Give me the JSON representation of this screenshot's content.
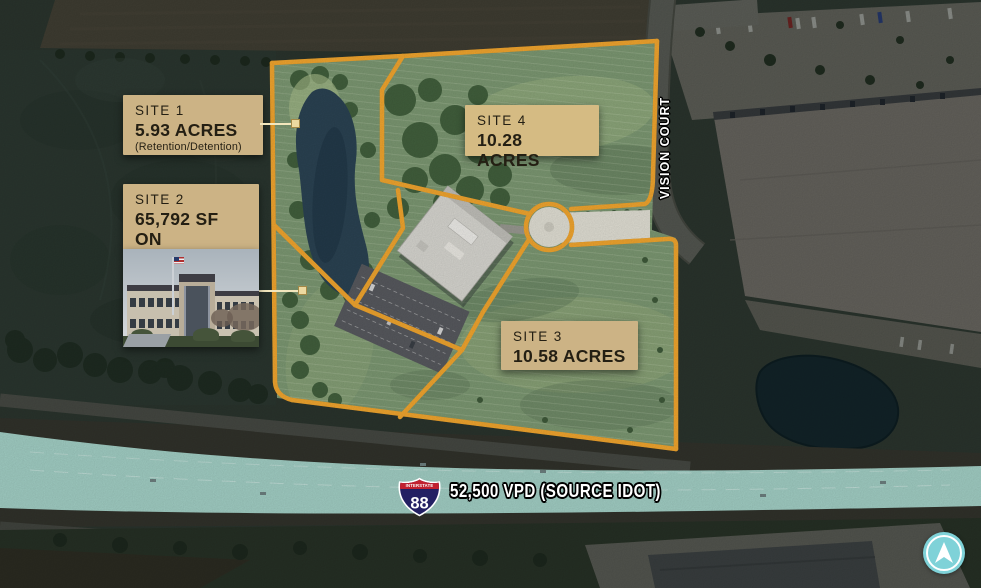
{
  "map": {
    "road_label": "VISION COURT",
    "highway": {
      "shield_label": "INTERSTATE",
      "shield_number": "88",
      "banner": "52,500 VPD (SOURCE IDOT)"
    },
    "sites": {
      "site1": {
        "title": "SITE 1",
        "acres": "5.93 ACRES",
        "note": "(Retention/Detention)"
      },
      "site2": {
        "title": "SITE 2",
        "line1": "65,792 SF ON",
        "line2": "9.24 ACRES"
      },
      "site3": {
        "title": "SITE 3",
        "acres": "10.58 ACRES"
      },
      "site4": {
        "title": "SITE 4",
        "acres": "10.28 ACRES"
      }
    },
    "colors": {
      "boundary": "#F3A72F",
      "label_bg": "#CCB385",
      "label_text": "#241F13",
      "highway_overlay": "#B7ECE2",
      "compass": "#7FD2D8",
      "shield_red": "#C2212F",
      "shield_blue": "#232063"
    }
  }
}
